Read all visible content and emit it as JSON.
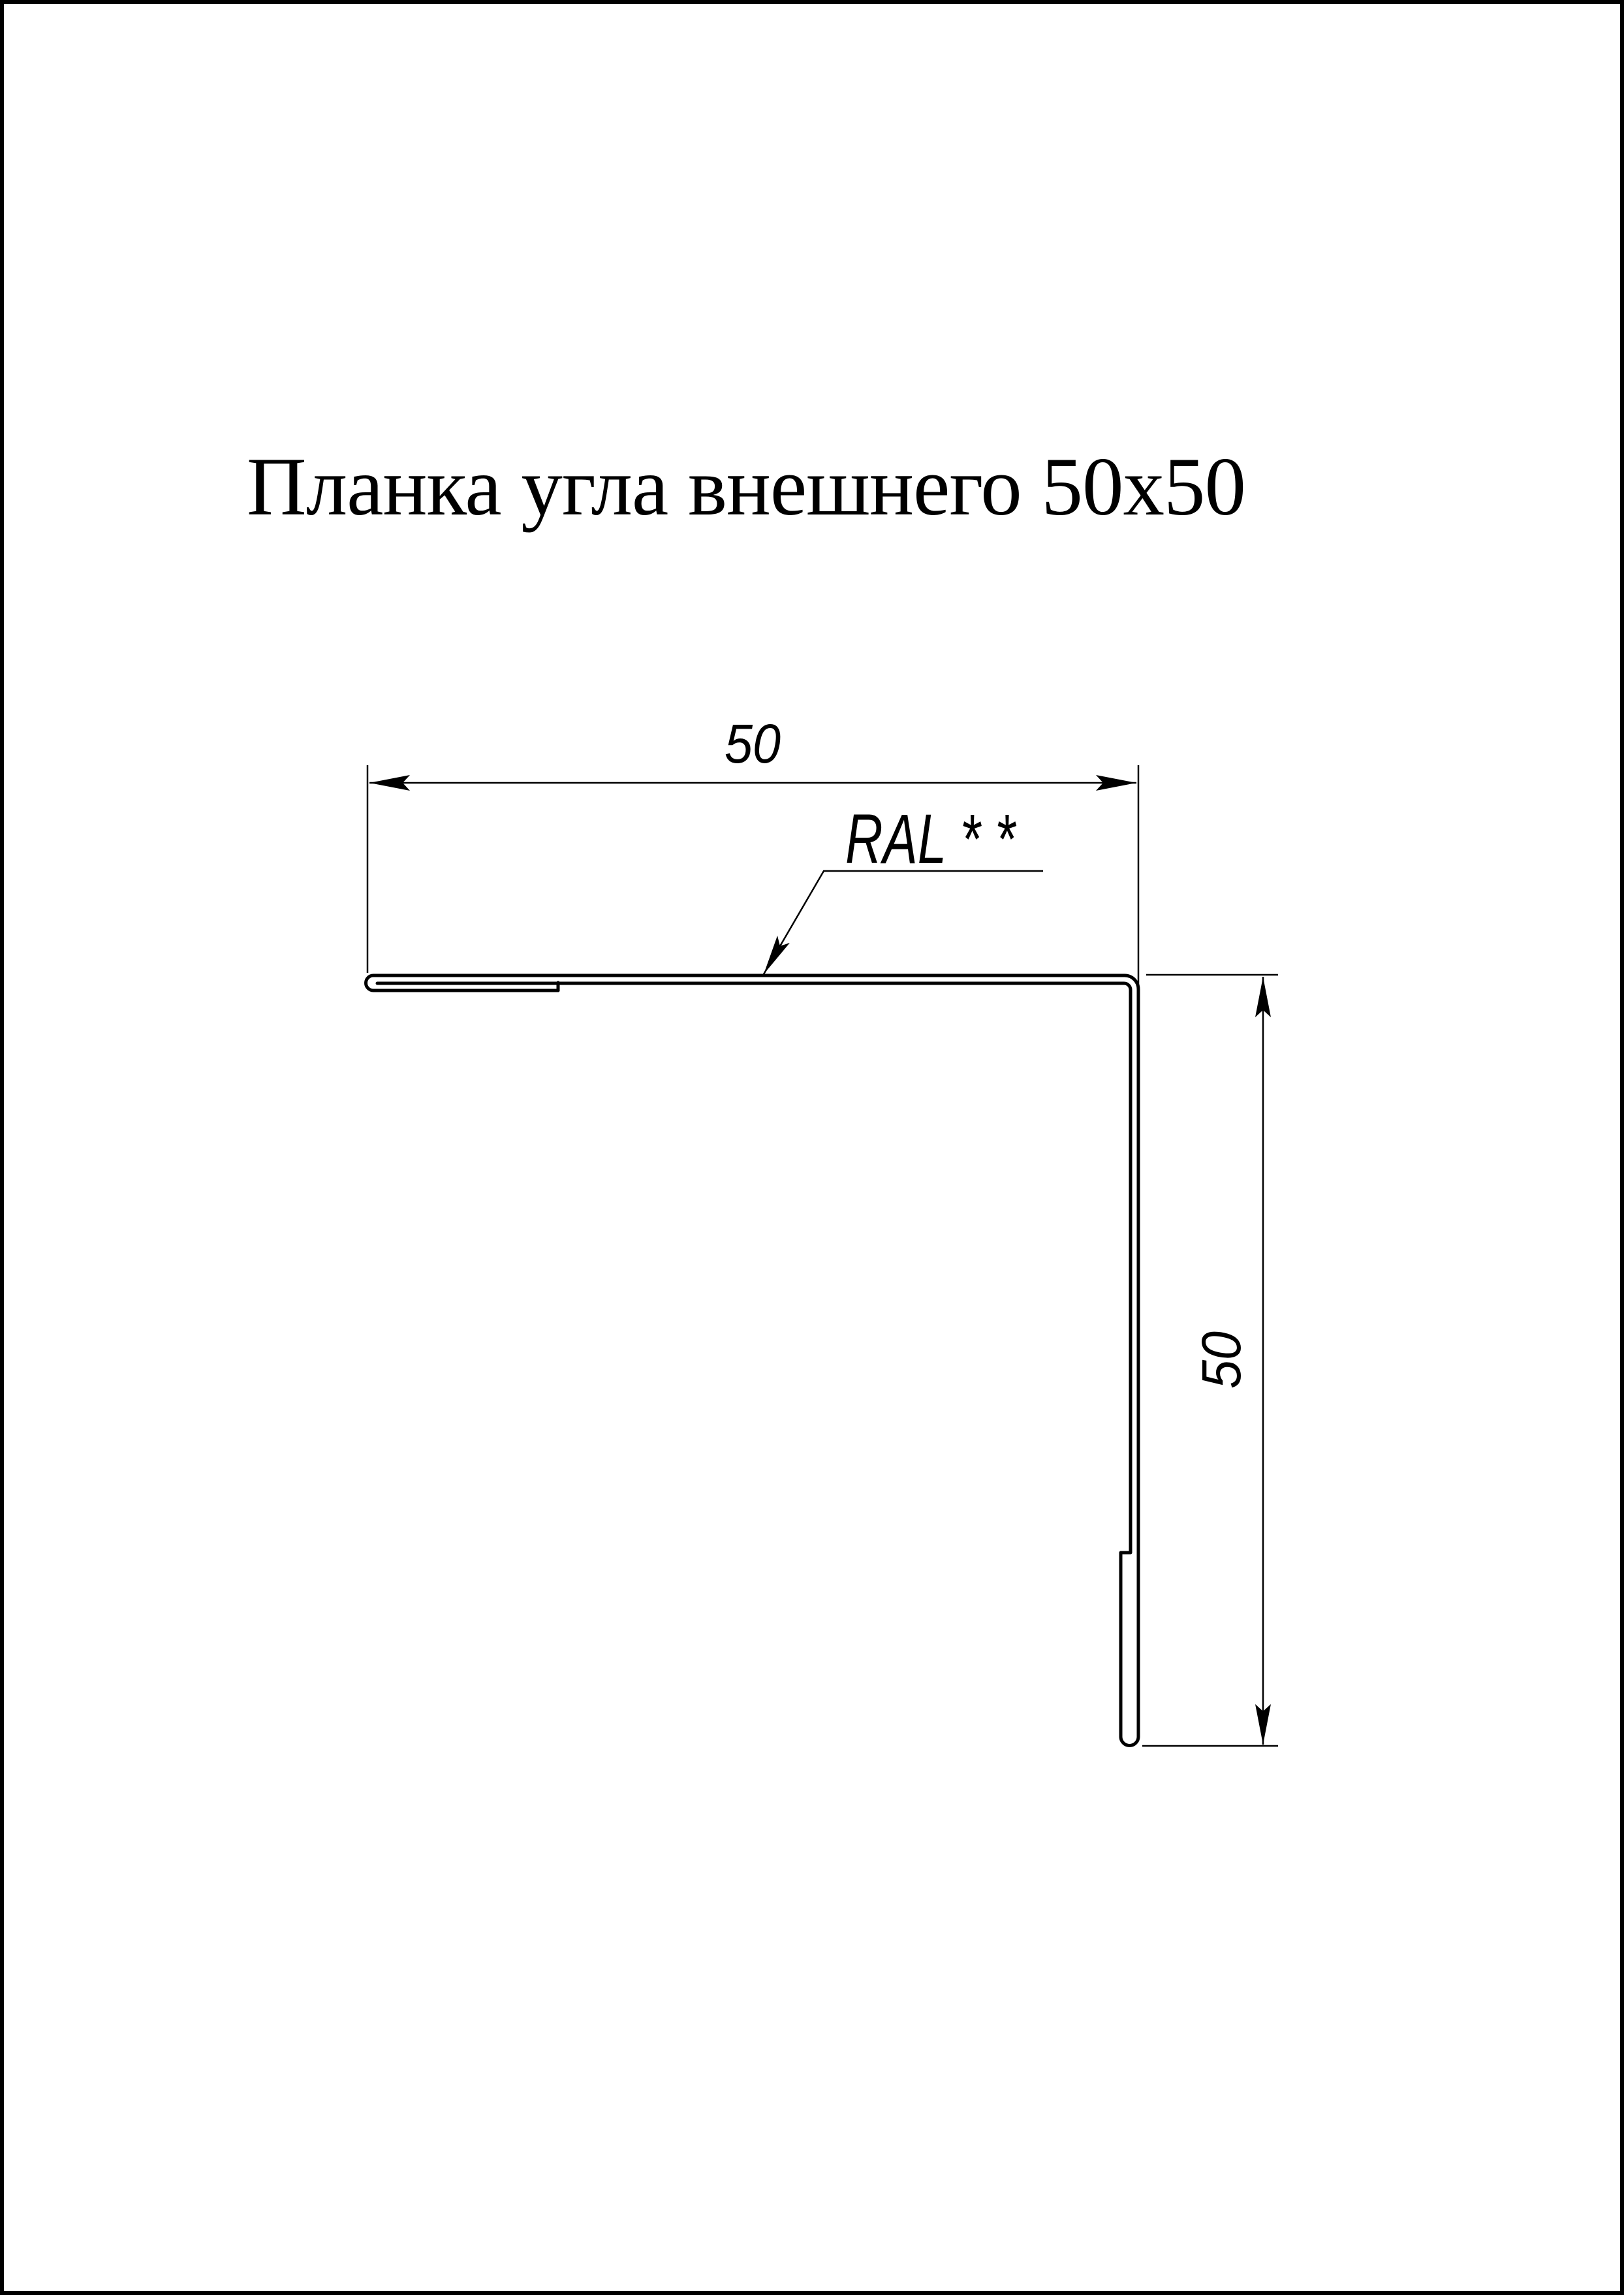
{
  "page": {
    "title": "Планка угла внешнего 50х50"
  },
  "dimensions": {
    "width_label": "50",
    "height_label": "50"
  },
  "annotations": {
    "coating": "RAL * *"
  },
  "colors": {
    "line": "#000000",
    "background": "#ffffff"
  }
}
